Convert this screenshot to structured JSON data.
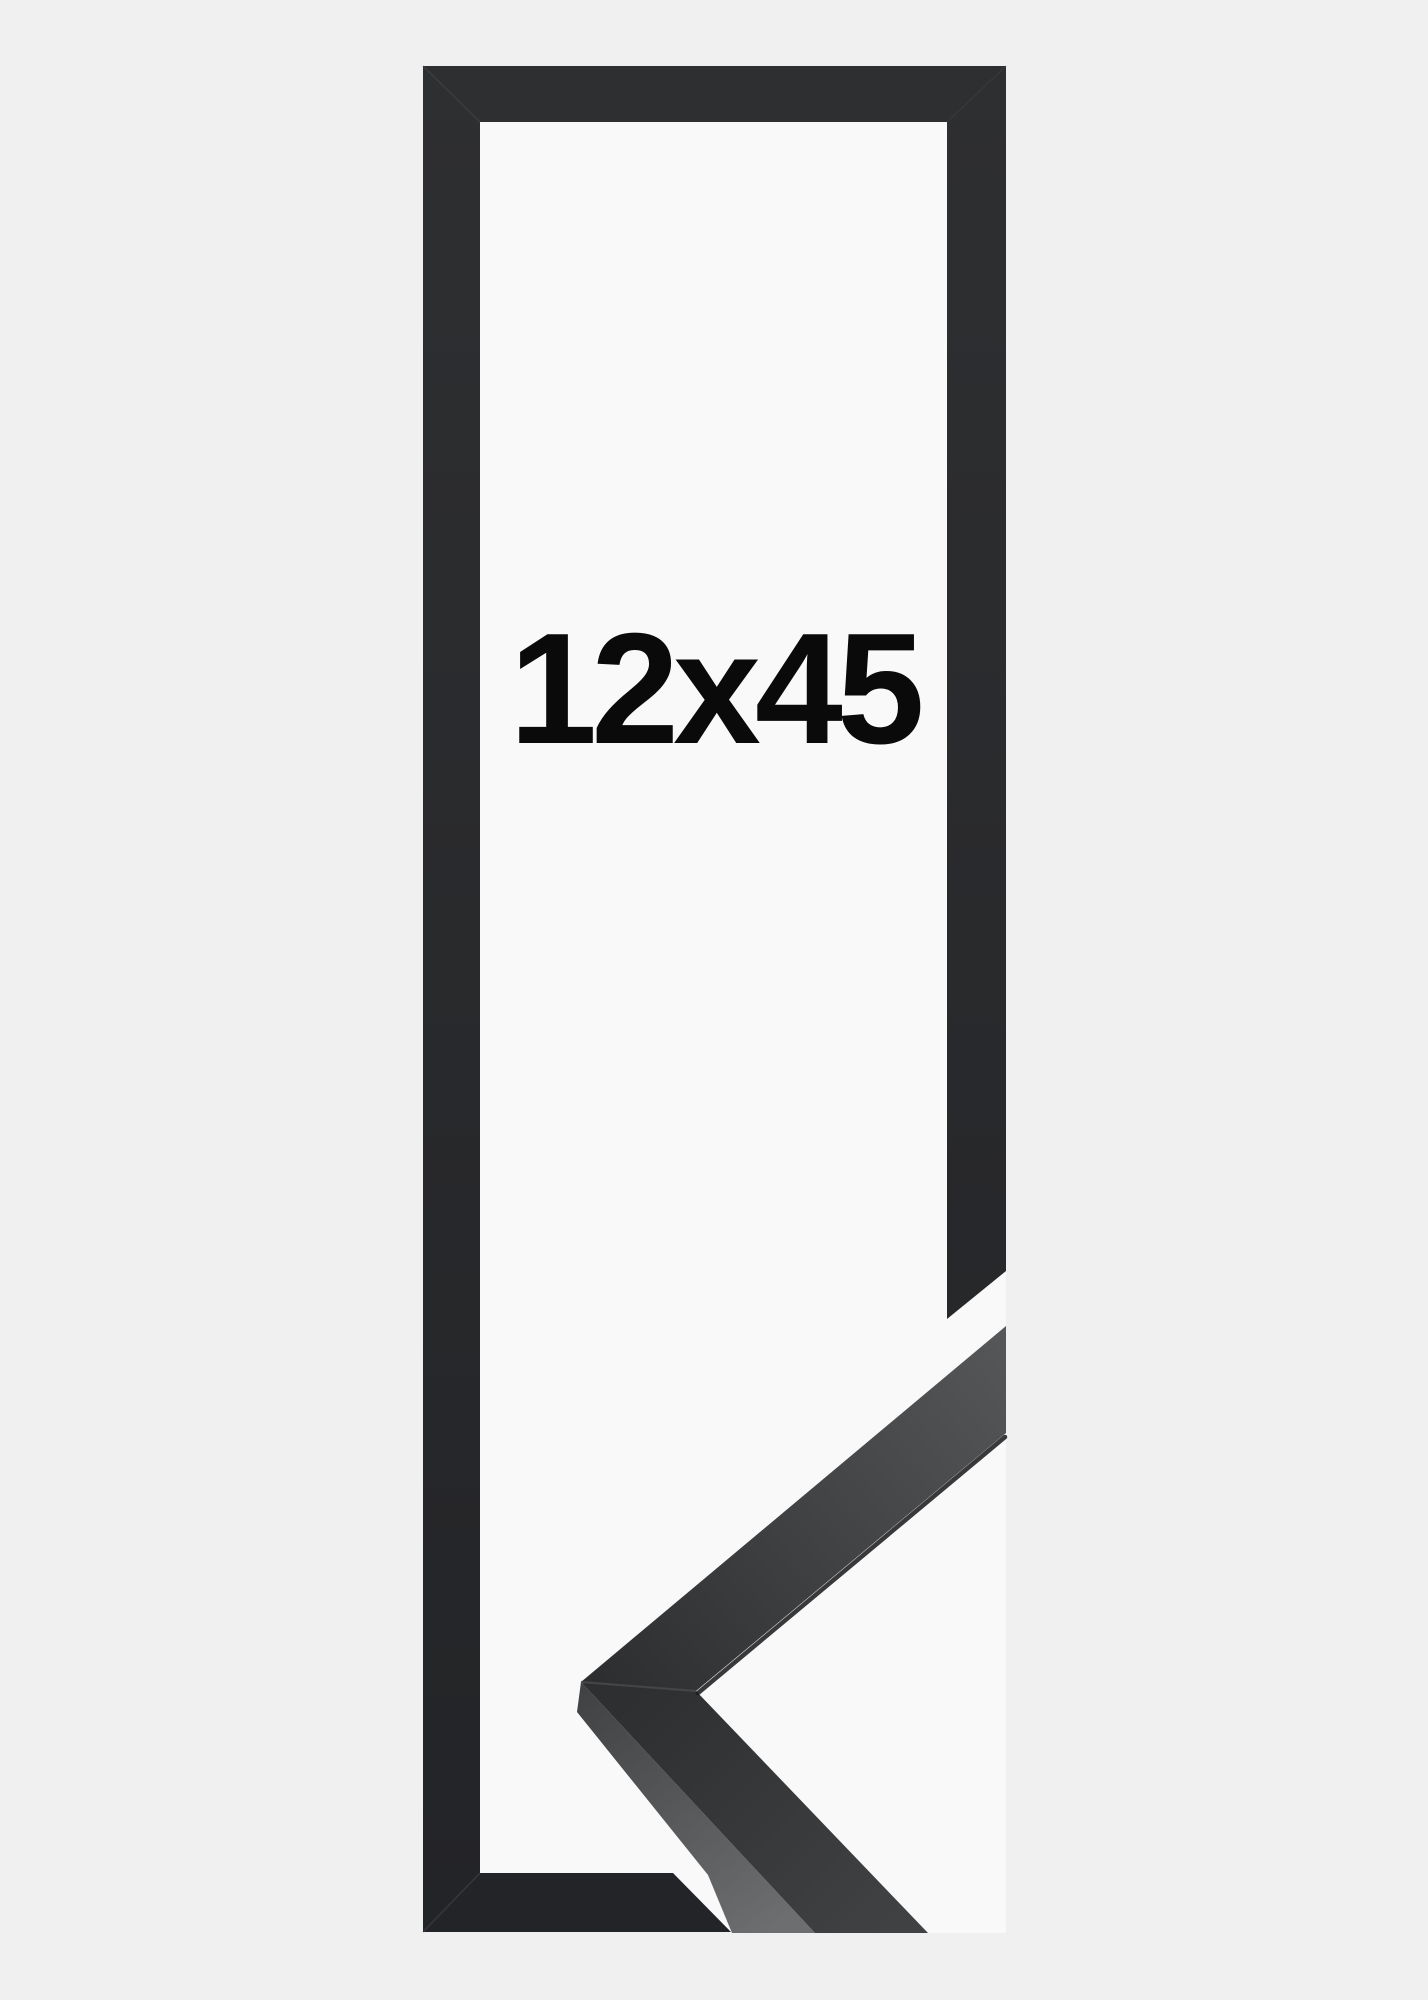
{
  "product": {
    "size_label": "12x45"
  },
  "colors": {
    "page_bg": "#f0f0f1",
    "photo_backing": "#f9f9fa",
    "frame_top": "#2e2f31",
    "frame_bottom": "#232427",
    "sample_face_dark": "#2c2d2f",
    "sample_face_light": "#555759",
    "sample_lower_dark": "#2e2f31",
    "sample_lower_light": "#3f4143",
    "sample_side_dark": "#3f4143",
    "sample_side_light": "#6c6e70",
    "seam": "#46484b",
    "edge_line": "#17181a",
    "label": "#0a0a0b"
  }
}
